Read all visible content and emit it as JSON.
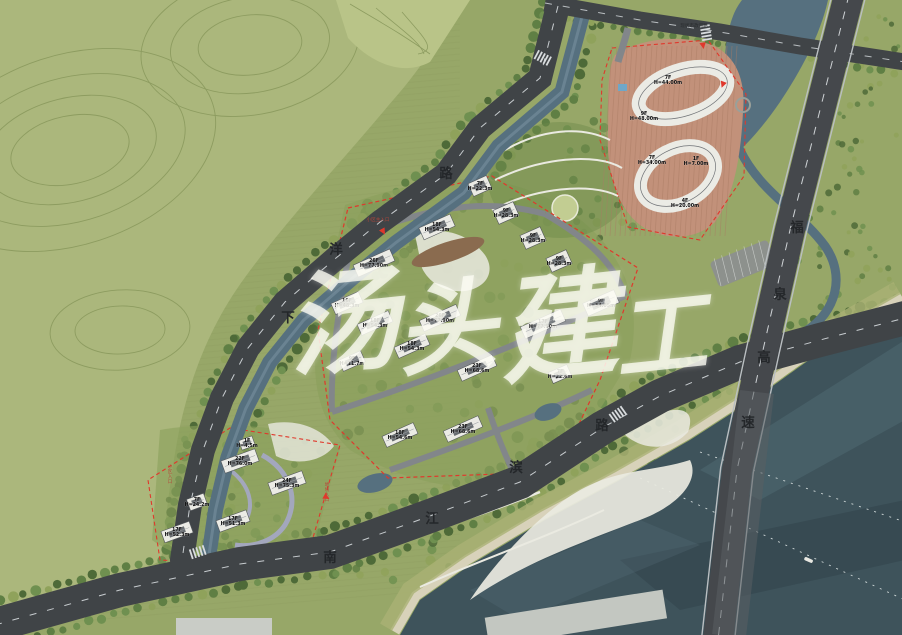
{
  "watermark": {
    "text": "汤头建工",
    "color": "rgba(252,252,244,0.78)",
    "chars": [
      {
        "ch": "汤",
        "x": 286,
        "y": 268,
        "size": 112
      },
      {
        "ch": "头",
        "x": 396,
        "y": 278,
        "size": 100
      },
      {
        "ch": "建",
        "x": 498,
        "y": 268,
        "size": 118
      },
      {
        "ch": "工",
        "x": 614,
        "y": 290,
        "size": 92
      }
    ]
  },
  "roads": [
    {
      "id": "xiayang-road",
      "name": "下洋路",
      "chars": [
        {
          "ch": "下",
          "x": 288,
          "y": 322
        },
        {
          "ch": "洋",
          "x": 336,
          "y": 254
        },
        {
          "ch": "路",
          "x": 446,
          "y": 178
        }
      ]
    },
    {
      "id": "nanjiangbin-road",
      "name": "南江滨路",
      "chars": [
        {
          "ch": "南",
          "x": 330,
          "y": 562
        },
        {
          "ch": "江",
          "x": 432,
          "y": 523
        },
        {
          "ch": "滨",
          "x": 516,
          "y": 472
        },
        {
          "ch": "路",
          "x": 602,
          "y": 430
        }
      ]
    },
    {
      "id": "fuquan-expressway",
      "name": "福泉高速",
      "chars": [
        {
          "ch": "福",
          "x": 797,
          "y": 232
        },
        {
          "ch": "泉",
          "x": 780,
          "y": 299
        },
        {
          "ch": "高",
          "x": 764,
          "y": 362
        },
        {
          "ch": "速",
          "x": 748,
          "y": 427
        }
      ]
    }
  ],
  "annotations": [
    {
      "label": "小区主入口",
      "x": 378,
      "y": 221,
      "vertical": false,
      "dark": false
    },
    {
      "label": "现状市政道路",
      "x": 694,
      "y": 27,
      "vertical": false,
      "dark": true
    },
    {
      "label": "小区入口",
      "x": 170,
      "y": 468,
      "vertical": true,
      "dark": false
    },
    {
      "label": "地块入口",
      "x": 327,
      "y": 486,
      "vertical": true,
      "dark": false
    }
  ],
  "entrance_markers": [
    {
      "x": 383,
      "y": 231,
      "a": 150
    },
    {
      "x": 703,
      "y": 45,
      "a": 170
    },
    {
      "x": 723,
      "y": 84,
      "a": 200
    },
    {
      "x": 326,
      "y": 497,
      "a": 120
    }
  ],
  "clusters": [
    {
      "id": "northeast-commercial",
      "buildings": [
        {
          "floors": "7F",
          "height": "H=44.00m",
          "x": 668,
          "y": 80,
          "shape": "none"
        },
        {
          "floors": "9F",
          "height": "H=48.00m",
          "x": 644,
          "y": 116,
          "shape": "none"
        },
        {
          "floors": "7F",
          "height": "H=34.00m",
          "x": 652,
          "y": 160,
          "shape": "none"
        },
        {
          "floors": "1F",
          "height": "H=7.00m",
          "x": 696,
          "y": 161,
          "shape": "none"
        },
        {
          "floors": "4F",
          "height": "H=20.00m",
          "x": 685,
          "y": 203,
          "shape": "none"
        }
      ]
    },
    {
      "id": "central-residential",
      "rot": -24,
      "buildings": [
        {
          "floors": "7F",
          "height": "H=22.3m",
          "x": 480,
          "y": 186,
          "w": 20,
          "h": 14
        },
        {
          "floors": "9F",
          "height": "H=28.3m",
          "x": 506,
          "y": 213,
          "w": 22,
          "h": 15
        },
        {
          "floors": "9F",
          "height": "H=28.3m",
          "x": 533,
          "y": 238,
          "w": 22,
          "h": 15
        },
        {
          "floors": "9F",
          "height": "H=28.3m",
          "x": 559,
          "y": 261,
          "w": 22,
          "h": 15
        },
        {
          "floors": "18F",
          "height": "H=54.3m",
          "x": 437,
          "y": 227,
          "w": 34,
          "h": 13
        },
        {
          "floors": "26F",
          "height": "H=77.90m",
          "x": 374,
          "y": 263,
          "w": 40,
          "h": 13
        },
        {
          "floors": "16F",
          "height": "H=48.3m",
          "x": 347,
          "y": 303,
          "w": 30,
          "h": 12
        },
        {
          "floors": "18F",
          "height": "H=54.3m",
          "x": 375,
          "y": 323,
          "w": 34,
          "h": 12
        },
        {
          "floors": "18F",
          "height": "H=54.3m",
          "x": 412,
          "y": 346,
          "w": 34,
          "h": 12
        },
        {
          "floors": "26F",
          "height": "H=77.90m",
          "x": 440,
          "y": 318,
          "w": 40,
          "h": 12
        },
        {
          "floors": "17F",
          "height": "H=77.90m",
          "x": 543,
          "y": 324,
          "w": 44,
          "h": 13
        },
        {
          "floors": "9F",
          "height": "H=11.7m",
          "x": 352,
          "y": 361,
          "w": 24,
          "h": 12
        },
        {
          "floors": "23F",
          "height": "H=68.6m",
          "x": 477,
          "y": 368,
          "w": 38,
          "h": 12
        },
        {
          "floors": "7F",
          "height": "H=22.6m",
          "x": 560,
          "y": 374,
          "w": 20,
          "h": 12
        },
        {
          "floors": "9F",
          "height": "H=34.05m",
          "x": 601,
          "y": 303,
          "w": 34,
          "h": 14
        },
        {
          "floors": "18F",
          "height": "H=54.6m",
          "x": 400,
          "y": 435,
          "w": 34,
          "h": 12
        },
        {
          "floors": "23F",
          "height": "H=68.6m",
          "x": 463,
          "y": 429,
          "w": 38,
          "h": 12
        }
      ]
    },
    {
      "id": "southwest-residential",
      "rot": -20,
      "buildings": [
        {
          "floors": "1F",
          "height": "H=4.5m",
          "x": 247,
          "y": 443,
          "w": 14,
          "h": 10
        },
        {
          "floors": "22F",
          "height": "H=76.0m",
          "x": 240,
          "y": 461,
          "w": 36,
          "h": 13
        },
        {
          "floors": "24F",
          "height": "H=75.3m",
          "x": 287,
          "y": 483,
          "w": 36,
          "h": 13
        },
        {
          "floors": "7F",
          "height": "H=24.2m",
          "x": 197,
          "y": 502,
          "w": 18,
          "h": 12
        },
        {
          "floors": "17F",
          "height": "H=51.3m",
          "x": 233,
          "y": 521,
          "w": 32,
          "h": 12
        },
        {
          "floors": "17F",
          "height": "H=52.3m",
          "x": 177,
          "y": 532,
          "w": 30,
          "h": 12
        }
      ]
    }
  ],
  "colors": {
    "farmland": "#adb97e",
    "farmland_line": "#8d9c60",
    "site_green": "#97a768",
    "park_green": "#8ba05c",
    "road": "#404447",
    "expressway": "#45484c",
    "canal": "#56707f",
    "river": "#3e535b",
    "river_light": "#5a757f",
    "river_dark": "#2f4249",
    "building": "#ebebe5",
    "roof": "#686d71",
    "boundary_red": "#e0382c",
    "paving_terracotta": "#c2917a",
    "paving_stripe": "#a97c64",
    "beach": "#d8d2ba",
    "path_white": "#eaeae1",
    "inner_road": "#82868a",
    "label_text": "#0b0b0c",
    "road_text": "#24272a",
    "entrance_text": "#b5473a",
    "trees": [
      "#4e6a38",
      "#5f7f44",
      "#6f9050",
      "#8fa25b"
    ]
  }
}
